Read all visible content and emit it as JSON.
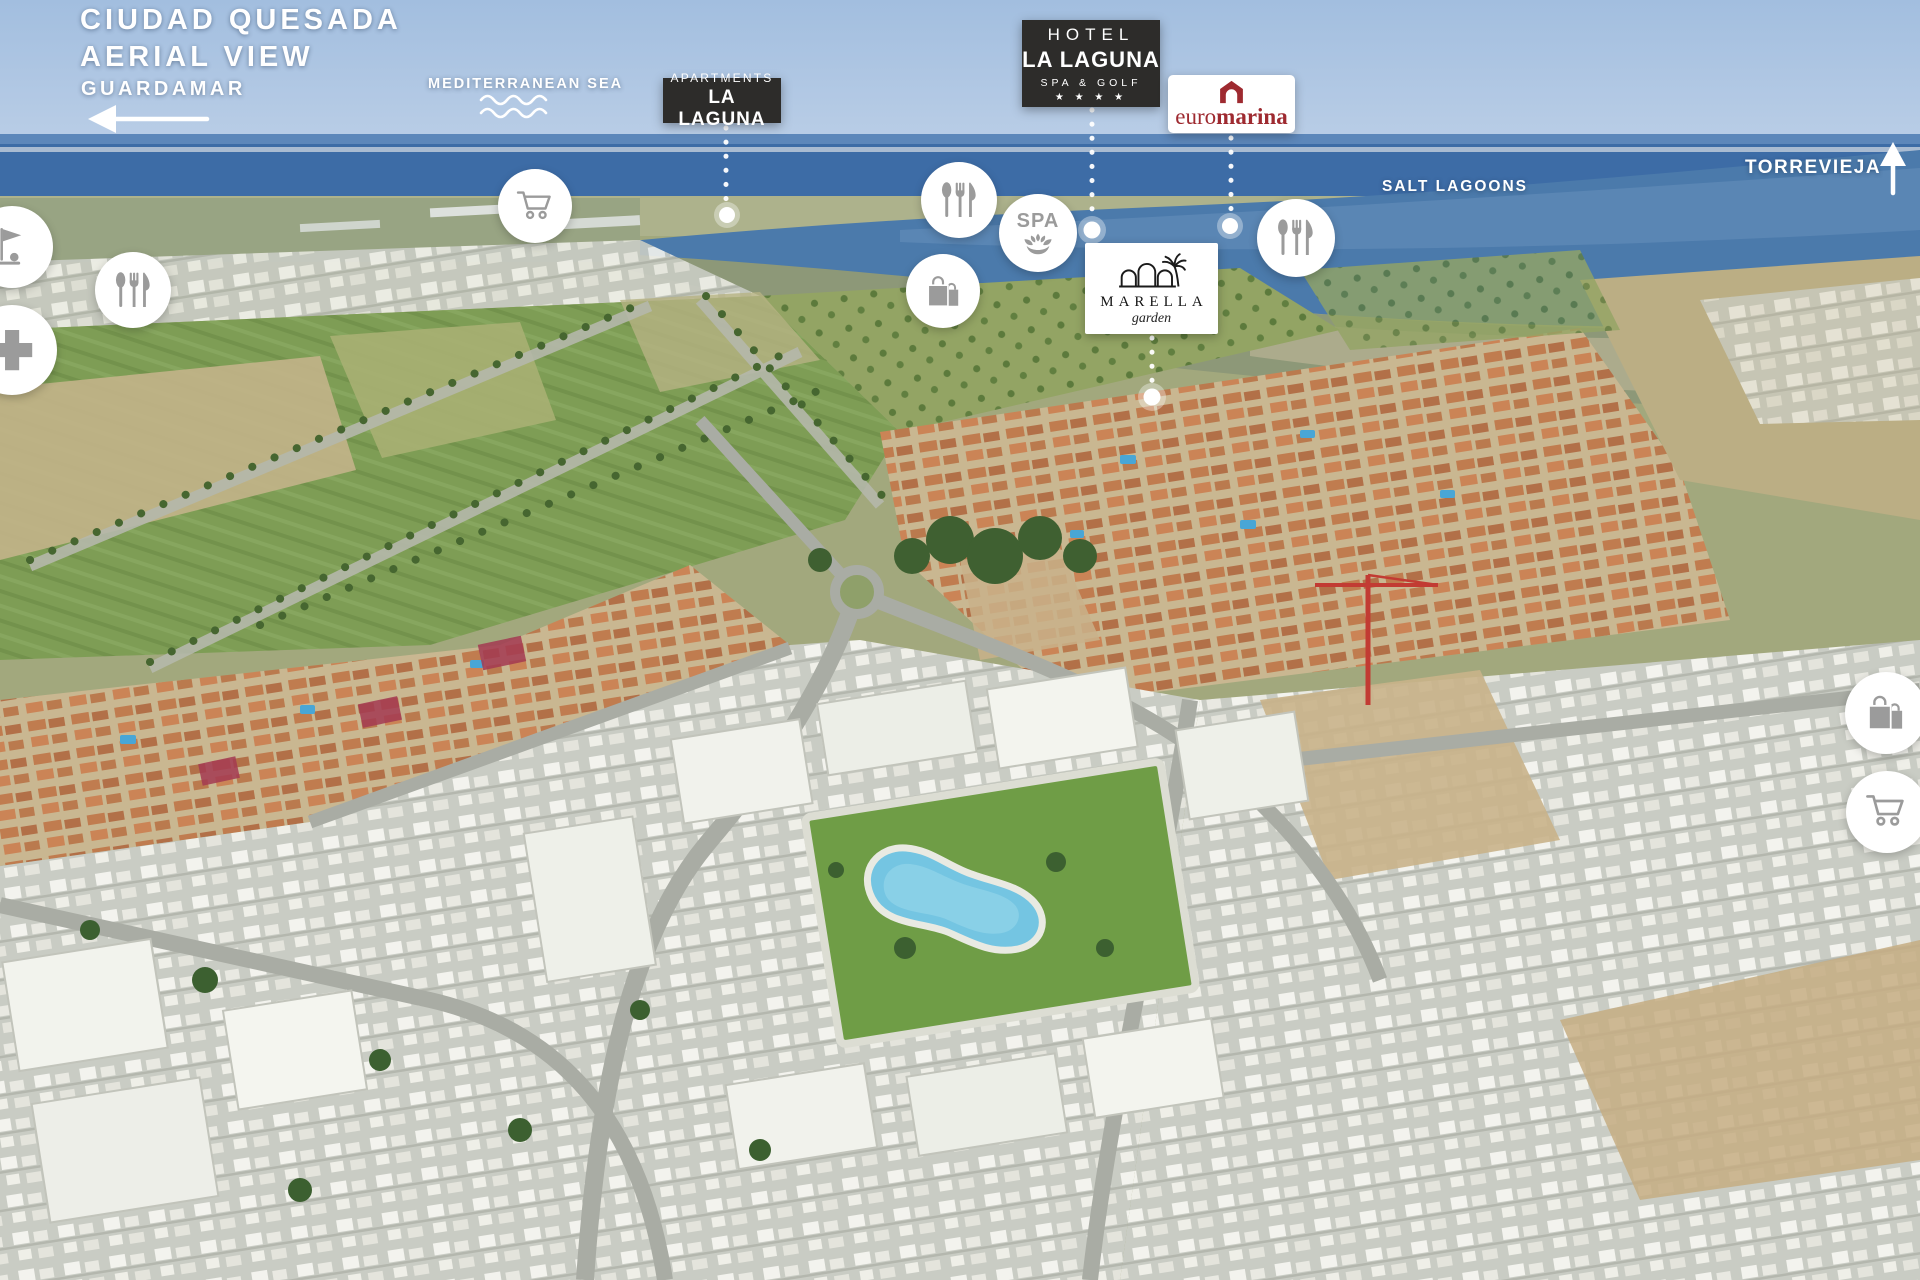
{
  "page": {
    "title_line1": "CIUDAD QUESADA",
    "title_line2": "AERIAL VIEW"
  },
  "directions": {
    "guardamar": {
      "label": "GUARDAMAR",
      "direction": "left"
    },
    "torrevieja": {
      "label": "TORREVIEJA",
      "direction": "up"
    }
  },
  "water_labels": {
    "mediterranean_sea": "MEDITERRANEAN SEA",
    "salt_lagoons": "SALT LAGOONS"
  },
  "location_badges": {
    "apartments_la_laguna": {
      "line1": "APARTMENTS",
      "line2": "LA LAGUNA"
    },
    "hotel_la_laguna": {
      "line1": "HOTEL",
      "line2": "LA LAGUNA",
      "line3": "SPA & GOLF",
      "stars": "★ ★ ★ ★"
    },
    "euromarina": {
      "word_regular": "euro",
      "word_bold": "marina"
    },
    "marella_garden": {
      "name": "MARELLA",
      "subtitle": "garden"
    }
  },
  "poi": {
    "spa_label": "SPA",
    "markers": [
      {
        "icon": "shopping-cart-icon",
        "meaning": "supermarket",
        "area": "upper fields"
      },
      {
        "icon": "restaurant-cutlery-icon",
        "meaning": "restaurant",
        "area": "near hotel"
      },
      {
        "icon": "spa-lotus-icon",
        "meaning": "spa",
        "area": "near hotel"
      },
      {
        "icon": "shopping-bag-icon",
        "meaning": "shopping",
        "area": "near hotel"
      },
      {
        "icon": "restaurant-cutlery-icon",
        "meaning": "restaurant",
        "area": "near euromarina"
      },
      {
        "icon": "golf-flag-icon",
        "meaning": "golf",
        "area": "left edge"
      },
      {
        "icon": "restaurant-cutlery-icon",
        "meaning": "restaurant",
        "area": "left edge"
      },
      {
        "icon": "medical-cross-icon",
        "meaning": "pharmacy-medical",
        "area": "left edge"
      },
      {
        "icon": "shopping-bag-icon",
        "meaning": "shopping",
        "area": "right edge"
      },
      {
        "icon": "shopping-cart-icon",
        "meaning": "supermarket",
        "area": "right edge"
      }
    ]
  },
  "colors": {
    "badge_dark": "#2d2c2a",
    "euromarina_red": "#9e2a30",
    "icon_gray": "#9b9b9b",
    "label_white": "#ffffff",
    "sea_blue": "#3d6ca6",
    "lagoon_blue": "#4b7aab",
    "pool_blue": "#74c5e2"
  }
}
